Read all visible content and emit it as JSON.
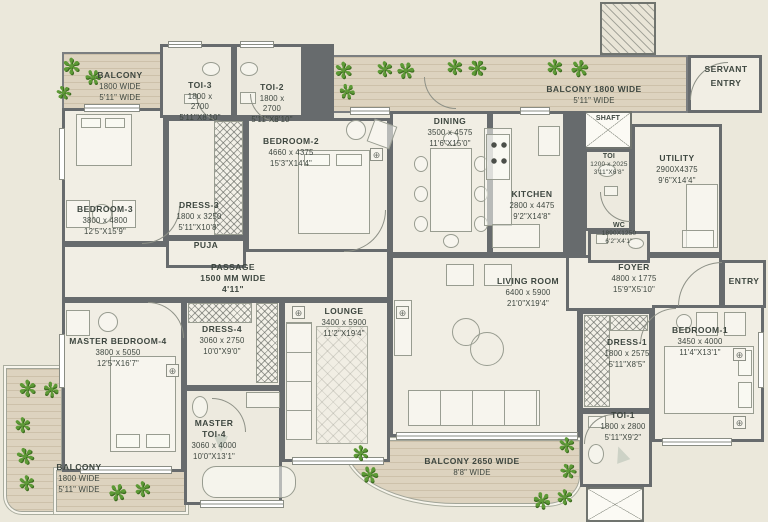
{
  "palette": {
    "wall": "#676b6d",
    "floor": "#f1eee4",
    "balcony": "#ddd3bf",
    "text": "#3d463f",
    "plant": "#5d9a36",
    "background": "#ebe8db"
  },
  "icons": {
    "plant": "✻",
    "point": "⊕"
  },
  "rooms": {
    "balcony_tl": {
      "name": "BALCONY",
      "l2": "1800 WIDE",
      "l3": "5'11\" WIDE"
    },
    "toi3": {
      "name": "TOI-3",
      "l2": "1800 x 2700",
      "l3": "5'11\"X8'10\""
    },
    "toi2": {
      "name": "TOI-2",
      "l2": "1800 x 2700",
      "l3": "5'11\"X8'10\""
    },
    "bedroom3": {
      "name": "BEDROOM-3",
      "l2": "3800 x 4800",
      "l3": "12'5\"X15'9\""
    },
    "dress3": {
      "name": "DRESS-3",
      "l2": "1800 x 3250",
      "l3": "5'11\"X10'8\""
    },
    "bedroom2": {
      "name": "BEDROOM-2",
      "l2": "4660 x 4375",
      "l3": "15'3\"X14'4\""
    },
    "puja": {
      "name": "PUJA"
    },
    "passage": {
      "name": "PASSAGE",
      "l2": "1500 MM WIDE",
      "l3": "4'11\""
    },
    "dining": {
      "name": "DINING",
      "l2": "3500 x 4575",
      "l3": "11'6\"X15'0\""
    },
    "kitchen": {
      "name": "KITCHEN",
      "l2": "2800 x 4475",
      "l3": "9'2\"X14'8\""
    },
    "balcony_top": {
      "name": "BALCONY 1800 WIDE",
      "l2": "5'11\" WIDE"
    },
    "servant_entry": {
      "name": "SERVANT ENTRY"
    },
    "shaft": {
      "name": "SHAFT"
    },
    "toi_s": {
      "name": "TOI",
      "l2": "1200 x 2025",
      "l3": "3'11\"X6'8\""
    },
    "utility": {
      "name": "UTILITY",
      "l2": "2900X4375",
      "l3": "9'6\"X14'4\""
    },
    "wc": {
      "name": "WC",
      "l2": "1890X1250",
      "l3": "6'2\"X4'1\""
    },
    "foyer": {
      "name": "FOYER",
      "l2": "4800 x 1775",
      "l3": "15'9\"X5'10\""
    },
    "entry": {
      "name": "ENTRY"
    },
    "living": {
      "name": "LIVING ROOM",
      "l2": "6400 x 5900",
      "l3": "21'0\"X19'4\""
    },
    "lounge": {
      "name": "LOUNGE",
      "l2": "3400 x 5900",
      "l3": "11'2\"X19'4\""
    },
    "dress4": {
      "name": "DRESS-4",
      "l2": "3060 x 2750",
      "l3": "10'0\"X9'0\""
    },
    "master_bedroom4": {
      "name": "MASTER BEDROOM-4",
      "l2": "3800 x 5050",
      "l3": "12'5\"X16'7\""
    },
    "master_toi4": {
      "name": "MASTER TOI-4",
      "l2": "3060 x 4000",
      "l3": "10'0\"X13'1\""
    },
    "dress1": {
      "name": "DRESS-1",
      "l2": "1800 x 2575",
      "l3": "5'11\"X8'5\""
    },
    "bedroom1": {
      "name": "BEDROOM-1",
      "l2": "3450 x 4000",
      "l3": "11'4\"X13'1\""
    },
    "toi1": {
      "name": "TOI-1",
      "l2": "1800 x 2800",
      "l3": "5'11\"X9'2\""
    },
    "balcony_bl": {
      "name": "BALCONY",
      "l2": "1800 WIDE",
      "l3": "5'11\" WIDE"
    },
    "balcony_bottom": {
      "name": "BALCONY 2650 WIDE",
      "l2": "8'8\" WIDE"
    }
  }
}
